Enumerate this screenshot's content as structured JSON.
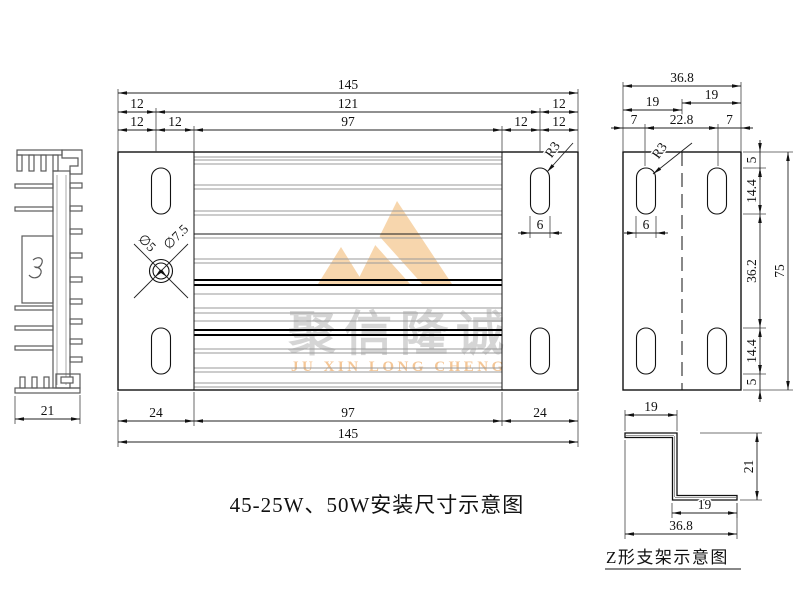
{
  "captions": {
    "main": "45-25W、50W安装尺寸示意图",
    "z_bracket": "Z形支架示意图"
  },
  "watermark": {
    "cn": "聚信隆诚",
    "en": "JU XIN LONG CHENG",
    "logo_color": "#f6cf9f",
    "cn_color": "#cecece",
    "en_color": "#f3bd84"
  },
  "colors": {
    "line": "#111111",
    "fin_gray": "#9a9a9a",
    "dim_line": "#333333"
  },
  "drawing": {
    "hdims": [
      {
        "x1": 118,
        "x2": 578,
        "y": 93,
        "label": "145"
      },
      {
        "x1": 118,
        "x2": 156,
        "y": 112,
        "label": "12"
      },
      {
        "x1": 156,
        "x2": 540,
        "y": 112,
        "label": "121"
      },
      {
        "x1": 540,
        "x2": 578,
        "y": 112,
        "label": "12"
      },
      {
        "x1": 118,
        "x2": 156,
        "y": 130,
        "label": "12"
      },
      {
        "x1": 156,
        "x2": 194,
        "y": 130,
        "label": "12"
      },
      {
        "x1": 194,
        "x2": 502,
        "y": 130,
        "label": "97"
      },
      {
        "x1": 502,
        "x2": 540,
        "y": 130,
        "label": "12"
      },
      {
        "x1": 540,
        "x2": 578,
        "y": 130,
        "label": "12"
      },
      {
        "x1": 118,
        "x2": 194,
        "y": 421,
        "label": "24"
      },
      {
        "x1": 194,
        "x2": 502,
        "y": 421,
        "label": "97"
      },
      {
        "x1": 502,
        "x2": 578,
        "y": 421,
        "label": "24"
      },
      {
        "x1": 118,
        "x2": 578,
        "y": 442,
        "label": "145"
      },
      {
        "x1": 530,
        "x2": 550,
        "y": 233,
        "label": "6",
        "small": true
      },
      {
        "x1": 623,
        "x2": 741,
        "y": 86,
        "label": "36.8"
      },
      {
        "x1": 682,
        "x2": 741,
        "y": 103,
        "label": "19"
      },
      {
        "x1": 623,
        "x2": 682,
        "y": 110,
        "label": "19"
      },
      {
        "x1": 623,
        "x2": 645,
        "y": 128,
        "label": "7",
        "small": true
      },
      {
        "x1": 645,
        "x2": 718,
        "y": 128,
        "label": "22.8"
      },
      {
        "x1": 718,
        "x2": 741,
        "y": 128,
        "label": "7",
        "small": true
      },
      {
        "x1": 636,
        "x2": 656,
        "y": 233,
        "label": "6",
        "small": true
      },
      {
        "x1": 15,
        "x2": 80,
        "y": 419,
        "label": "21"
      },
      {
        "x1": 625,
        "x2": 677,
        "y": 415,
        "label": "19"
      },
      {
        "x1": 672,
        "x2": 737,
        "y": 513,
        "label": "19"
      },
      {
        "x1": 625,
        "x2": 737,
        "y": 534,
        "label": "36.8"
      }
    ],
    "vdims": [
      {
        "y1": 152,
        "y2": 168,
        "x": 760,
        "label": "5",
        "small": true
      },
      {
        "y1": 168,
        "y2": 214,
        "x": 760,
        "label": "14.4"
      },
      {
        "y1": 214,
        "y2": 328,
        "x": 760,
        "label": "36.2"
      },
      {
        "y1": 328,
        "y2": 374,
        "x": 760,
        "label": "14.4"
      },
      {
        "y1": 374,
        "y2": 390,
        "x": 760,
        "label": "5",
        "small": true
      },
      {
        "y1": 152,
        "y2": 390,
        "x": 788,
        "label": "75"
      },
      {
        "y1": 433,
        "y2": 500,
        "x": 757,
        "label": "21"
      }
    ],
    "leaders": [
      {
        "label": "R3",
        "lx": 573,
        "ly": 143,
        "ax": 547,
        "ay": 172,
        "tx": 556,
        "ty": 152,
        "rot": -55
      },
      {
        "label": "R3",
        "lx": 692,
        "ly": 143,
        "ax": 653,
        "ay": 174,
        "tx": 663,
        "ty": 153,
        "rot": -55
      }
    ],
    "xcallout": {
      "cx": 161,
      "cy": 271,
      "r_inner": 8,
      "r_outer": 11.5,
      "label_inner": "∅5",
      "label_outer": "∅7.5"
    },
    "extlines": [
      [
        118,
        89,
        118,
        152
      ],
      [
        578,
        89,
        578,
        152
      ],
      [
        156,
        108,
        156,
        152
      ],
      [
        540,
        108,
        540,
        152
      ],
      [
        194,
        126,
        194,
        152
      ],
      [
        502,
        126,
        502,
        152
      ],
      [
        118,
        392,
        118,
        447
      ],
      [
        578,
        392,
        578,
        447
      ],
      [
        194,
        392,
        194,
        426
      ],
      [
        502,
        392,
        502,
        426
      ],
      [
        530,
        216,
        530,
        238
      ],
      [
        550,
        216,
        550,
        238
      ],
      [
        623,
        82,
        623,
        152
      ],
      [
        741,
        82,
        741,
        152
      ],
      [
        682,
        99,
        682,
        115
      ],
      [
        645,
        124,
        645,
        166
      ],
      [
        718,
        124,
        718,
        166
      ],
      [
        743,
        152,
        793,
        152
      ],
      [
        743,
        390,
        793,
        390
      ],
      [
        743,
        168,
        766,
        168
      ],
      [
        743,
        214,
        766,
        214
      ],
      [
        743,
        328,
        766,
        328
      ],
      [
        743,
        374,
        766,
        374
      ],
      [
        636,
        216,
        636,
        238
      ],
      [
        656,
        216,
        656,
        238
      ],
      [
        15,
        396,
        15,
        424
      ],
      [
        80,
        395,
        80,
        424
      ],
      [
        625,
        410,
        625,
        431
      ],
      [
        677,
        410,
        677,
        431
      ],
      [
        700,
        433,
        762,
        433
      ],
      [
        740,
        500,
        762,
        500
      ],
      [
        672,
        503,
        672,
        518
      ],
      [
        737,
        503,
        737,
        518
      ],
      [
        625,
        440,
        625,
        539
      ],
      [
        737,
        503,
        737,
        539
      ]
    ],
    "fins": [
      [
        157,
        "g"
      ],
      [
        160,
        "g"
      ],
      [
        164,
        "g"
      ],
      [
        185,
        "g"
      ],
      [
        189,
        "g"
      ],
      [
        211,
        "g"
      ],
      [
        215,
        "g"
      ],
      [
        234,
        "k"
      ],
      [
        238,
        "g"
      ],
      [
        259,
        "g"
      ],
      [
        263,
        "g"
      ],
      [
        280,
        "K"
      ],
      [
        285,
        "K"
      ],
      [
        294,
        "g"
      ],
      [
        308,
        "g"
      ],
      [
        313,
        "g"
      ],
      [
        321,
        "g"
      ],
      [
        330,
        "K"
      ],
      [
        335,
        "K"
      ],
      [
        349,
        "g"
      ],
      [
        353,
        "g"
      ],
      [
        368,
        "g"
      ],
      [
        372,
        "g"
      ],
      [
        383,
        "g"
      ],
      [
        387,
        "g"
      ]
    ]
  }
}
